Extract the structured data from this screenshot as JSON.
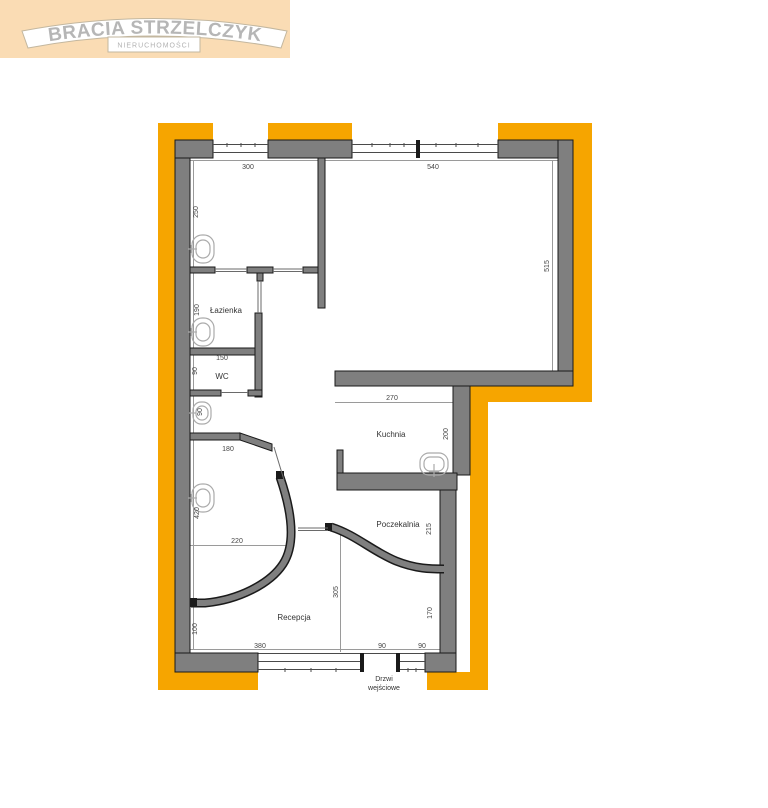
{
  "logo": {
    "brand": "BRACIA STRZELCZYK",
    "subtitle": "NIERUCHOMOŚCI",
    "bg_color": "#FADCB4",
    "text_color": "#B6B6B6"
  },
  "floorplan": {
    "colors": {
      "outline_highlight": "#F6A500",
      "wall": "#7F7F7F",
      "wall_edge": "#1A1A1A",
      "dimension_text": "#444444"
    },
    "rooms": {
      "lazienka": "Łazienka",
      "wc": "WC",
      "kuchnia": "Kuchnia",
      "poczekalnia": "Poczekalnia",
      "recepcja": "Recepcja"
    },
    "entrance": {
      "line1": "Drzwi",
      "line2": "wejściowe"
    },
    "dims": [
      "300",
      "540",
      "250",
      "515",
      "190",
      "150",
      "90",
      "90",
      "270",
      "200",
      "180",
      "420",
      "220",
      "215",
      "305",
      "170",
      "100",
      "380",
      "90",
      "90"
    ]
  }
}
